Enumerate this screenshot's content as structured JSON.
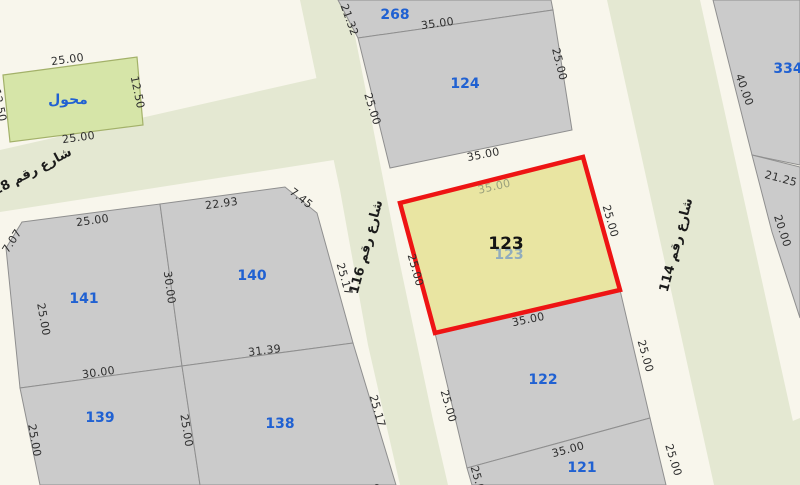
{
  "colors": {
    "background": "#f8f6ec",
    "street_band": "#e4e8d2",
    "parcel_fill": "#cbcbcb",
    "parcel_stroke": "#8f8f8f",
    "highlight_fill": "#e9e5a2",
    "highlight_stroke": "#ee1414",
    "transformer_parcel_fill": "#d6e5a8",
    "parcel_number_blue": "#2061d2",
    "dimension_text": "#2e2e2e"
  },
  "streets": [
    {
      "name": "شارع رقم 118"
    },
    {
      "name": "شارع رقم 116"
    },
    {
      "name": "شارع رقم 114"
    }
  ],
  "highlighted_parcel": {
    "number": "123",
    "ghost_number": "123",
    "dims": {
      "top_inner": "35.00",
      "left": "25.00",
      "right": "25.00",
      "bottom": "35.00"
    }
  },
  "parcels": [
    {
      "id": "transformer",
      "label": "محول",
      "dims": {
        "top": "25.00",
        "right": "12.50",
        "bottom": "25.00",
        "left": "12.50"
      }
    },
    {
      "id": "141",
      "number": "141",
      "dims": {
        "top": "25.00",
        "chamfer": "7.07",
        "left": "25.00",
        "right": "30.00",
        "bottom": "30.00"
      }
    },
    {
      "id": "140",
      "number": "140",
      "dims": {
        "top": "22.93",
        "chamfer": "7.45",
        "right": "25.17",
        "bottom": "31.39"
      }
    },
    {
      "id": "139",
      "number": "139",
      "dims": {
        "left": "25.00",
        "right": "25.00"
      }
    },
    {
      "id": "138",
      "number": "138",
      "dims": {
        "right": "25.17",
        "bottom": "31.28"
      }
    },
    {
      "id": "268",
      "number": "268",
      "dims": {
        "left": "21.32",
        "bottom": "35.00"
      }
    },
    {
      "id": "124",
      "number": "124",
      "dims": {
        "left": "25.00",
        "right": "25.00",
        "bottom": "35.00"
      }
    },
    {
      "id": "122",
      "number": "122",
      "dims": {
        "left": "25.00",
        "right": "25.00",
        "bottom": "35.00"
      }
    },
    {
      "id": "121",
      "number": "121",
      "dims": {
        "left": "25.00",
        "right": "25.00"
      }
    },
    {
      "id": "334",
      "number": "334",
      "dims": {
        "left": "40.00",
        "bottom": "21.25",
        "side": "20.00"
      }
    }
  ]
}
